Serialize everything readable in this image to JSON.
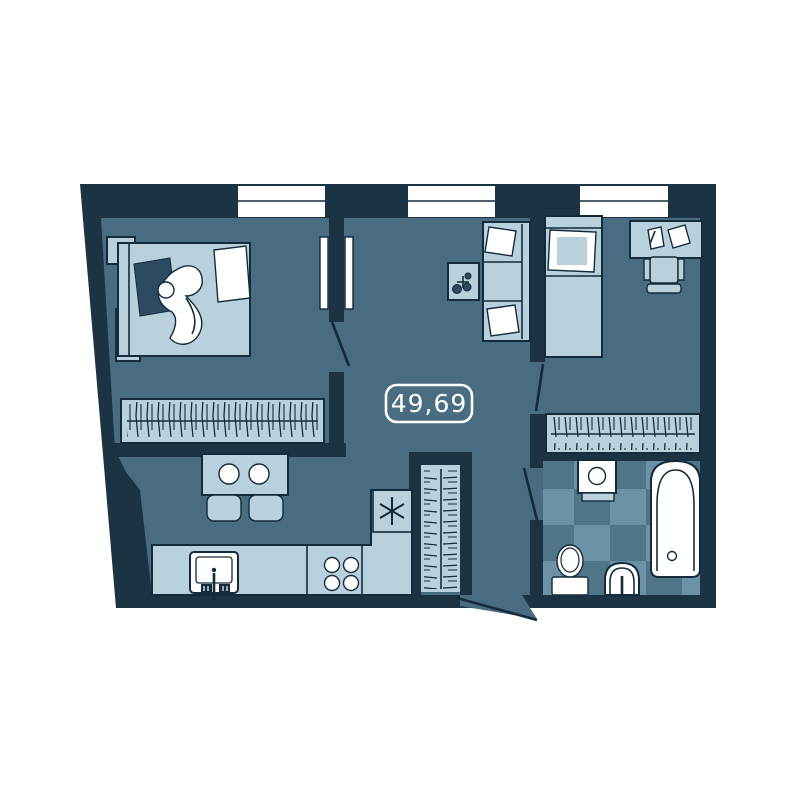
{
  "plan": {
    "area_label": "49,69"
  },
  "palette": {
    "background": "#ffffff",
    "wall": "#1b3343",
    "floor": "#4a6c80",
    "furniture": "#b9d0dd",
    "white": "#ffffff",
    "outline": "#132b3a",
    "accent_dark": "#2c4b60",
    "checker_light": "#6d92a5",
    "checker_dark": "#4f7587"
  },
  "furniture": {
    "bedroom_left": [
      "double-bed",
      "person-sleeping",
      "nightstand",
      "nightstand",
      "wardrobe-with-hangers",
      "window"
    ],
    "living_room": [
      "sofa",
      "side-table",
      "window",
      "wall-panels"
    ],
    "bedroom_right": [
      "single-bed",
      "desk",
      "desk-chair",
      "papers",
      "wardrobe-with-hangers",
      "window"
    ],
    "kitchen": [
      "dining-table",
      "plates",
      "chairs",
      "kitchen-sink",
      "stove-4-burners",
      "fridge-snowflake",
      "counter"
    ],
    "hallway": [
      "closet-with-hangers",
      "entry-door"
    ],
    "bathroom": [
      "washing-machine",
      "bathtub",
      "toilet",
      "wash-basin",
      "checker-tile-floor"
    ]
  }
}
